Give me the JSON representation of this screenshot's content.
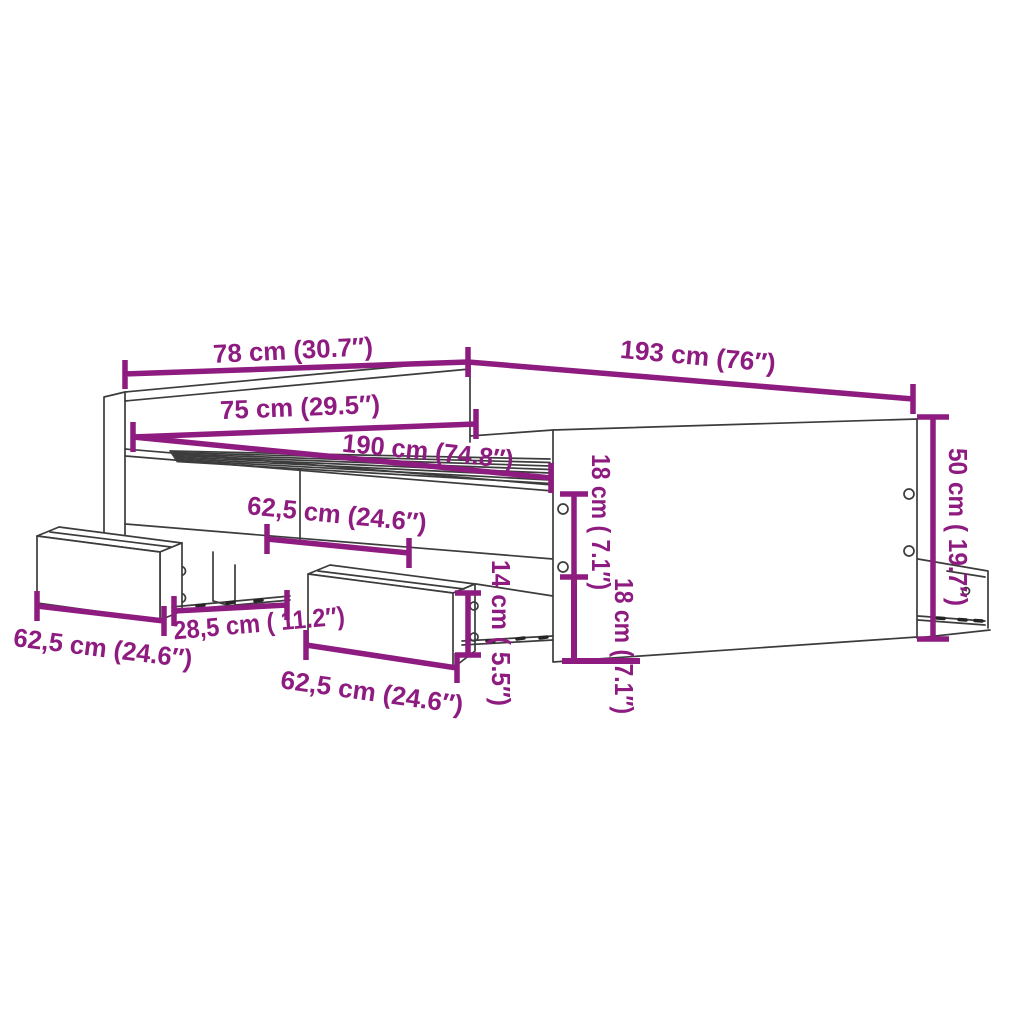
{
  "diagram": {
    "type": "product-dimension-diagram",
    "subject": "bed frame with headboard, footboard and storage drawers",
    "background_color": "#ffffff",
    "accent_color": "#8E1B7F",
    "line_color": "#3c3c3c",
    "parts": [
      "headboard",
      "slatted base",
      "side rail",
      "footboard",
      "left storage drawer",
      "middle storage drawer",
      "right storage drawer"
    ],
    "labels": {
      "headboard_width_outer": "78 cm (30.7″)",
      "frame_length_outer": "193 cm (76″)",
      "headboard_width_inner": "75 cm (29.5″)",
      "frame_length_inner": "190 cm (74.8″)",
      "drawer_top_width": "62,5 cm (24.6″)",
      "side_rail_height_upper": "18 cm ( 7.1″)",
      "side_rail_height_lower": "18 cm ( 7.1″)",
      "drawer_front_height": "14 cm ( 5.5″)",
      "footboard_height": "50 cm ( 19.7″)",
      "drawer_left_width": "62,5 cm (24.6″)",
      "drawer_gap_width": "28,5 cm ( 11.2″)",
      "drawer_mid_width": "62,5 cm (24.6″)"
    }
  }
}
